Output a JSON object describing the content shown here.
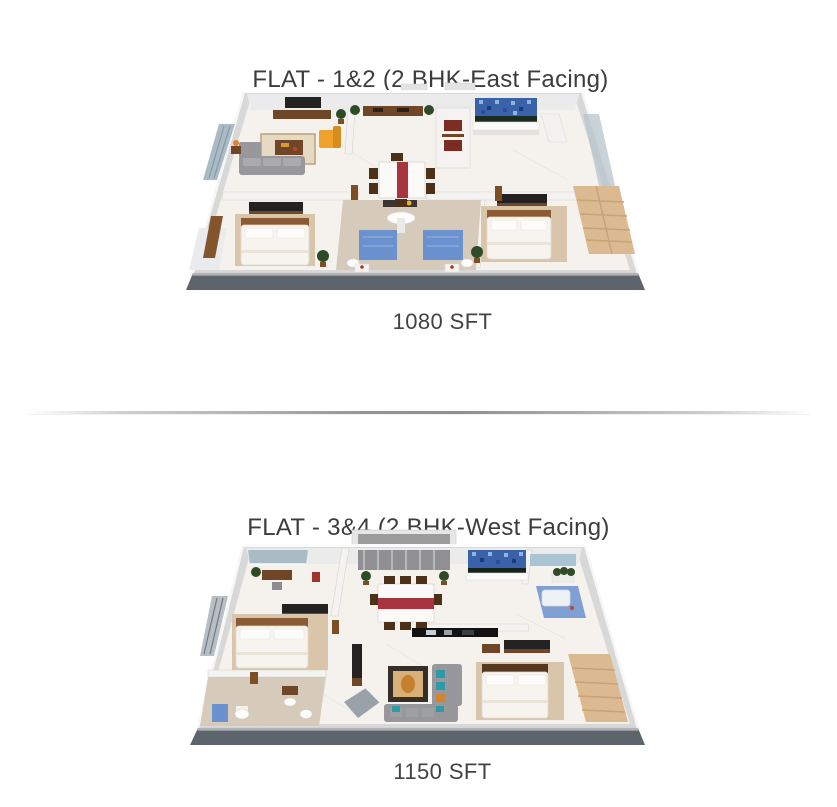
{
  "flats": [
    {
      "title": "FLAT - 1&2 (2 BHK-East Facing)",
      "area_label": "1080 SFT"
    },
    {
      "title": "FLAT - 3&4 (2 BHK-West Facing)",
      "area_label": "1150 SFT"
    }
  ],
  "palette": {
    "background": "#ffffff",
    "title_text": "#3c3c3c",
    "area_text": "#474041",
    "divider_gray": "#979797",
    "wall_light": "#d8d8d8",
    "wall_face": "#ebebeb",
    "floor_marble": "#f5f2ee",
    "plinth_gray": "#5d646b",
    "plinth_lip": "#aeb3b8",
    "kitchen_tile_blue": "#3a62a8",
    "kitchen_tile_light": "#8fb4e2",
    "kitchen_tile_dark": "#1c3a78",
    "runner_red": "#a83440",
    "wood_brown": "#6f4628",
    "dark_console": "#232220",
    "wardrobe_tan": "#dcba91",
    "carpet_tan": "#d9c6aa",
    "bed_white": "#f7f4f0",
    "sofa_gray": "#98989c",
    "chair_yellow": "#efa32d",
    "plant_green": "#2f4a26",
    "bath_blue": "#6b92cf",
    "glass_blue": "#b6c4cd",
    "curtain_gray": "#909092",
    "balcony_blue": "#a9bcc6",
    "teal_cushion": "#2d9aa8",
    "bath_tile_tan": "#d6cabb"
  }
}
